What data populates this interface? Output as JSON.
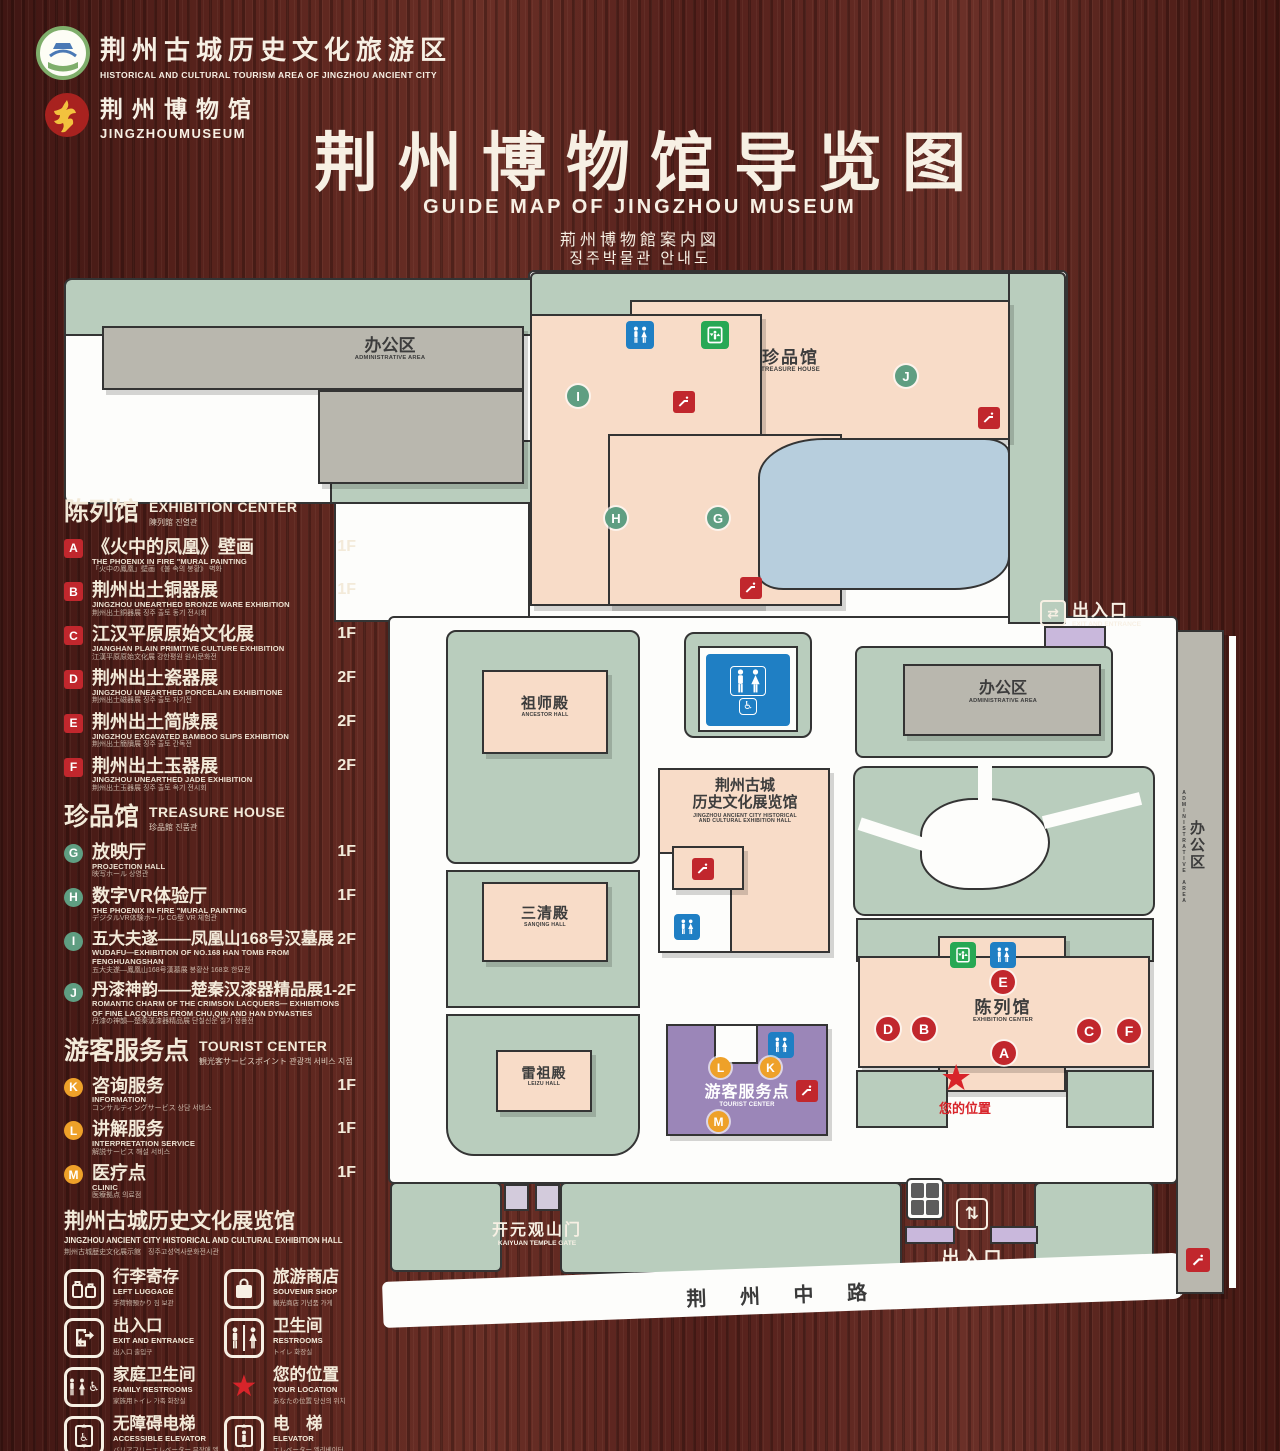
{
  "header": {
    "logo1": {
      "zh": "荆州古城历史文化旅游区",
      "en": "HISTORICAL AND CULTURAL TOURISM AREA OF JINGZHOU ANCIENT CITY"
    },
    "logo2": {
      "zh": "荆州博物馆",
      "en": "JINGZHOUMUSEUM"
    },
    "title": "荆州博物馆导览图",
    "subtitle_en": "GUIDE MAP OF JINGZHOU MUSEUM",
    "subtitle_ja": "荊州博物館案内図",
    "subtitle_ko": "징주박물관 안내도"
  },
  "panel": {
    "exhibition": {
      "zh": "陈列馆",
      "en": "EXHIBITION CENTER",
      "sub": "陳列館  진열관",
      "items": [
        {
          "k": "A",
          "zh": "《火中的凤凰》壁画",
          "en": "THE PHOENIX IN FIRE \"MURAL PAINTING",
          "sub": "「火中の鳳凰」壁画  《불 속의 봉황》 벽화",
          "floor": "1F"
        },
        {
          "k": "B",
          "zh": "荆州出土铜器展",
          "en": "JINGZHOU UNEARTHED BRONZE WARE EXHIBITION",
          "sub": "荆州出土銅器展  징주 출토 동기 전시회",
          "floor": "1F"
        },
        {
          "k": "C",
          "zh": "江汉平原原始文化展",
          "en": "JIANGHAN PLAIN PRIMITIVE CULTURE EXHIBITION",
          "sub": "江漢平原原始文化展  강한평원 원시문화전",
          "floor": "1F"
        },
        {
          "k": "D",
          "zh": "荆州出土瓷器展",
          "en": "JINGZHOU UNEARTHED PORCELAIN EXHIBITIONE",
          "sub": "荆州出土磁器展  징주 출토 자기전",
          "floor": "2F"
        },
        {
          "k": "E",
          "zh": "荆州出土简牍展",
          "en": "JINGZHOU EXCAVATED BAMBOO SLIPS EXHIBITION",
          "sub": "荆州出土簡牘展  징주 출토 간독전",
          "floor": "2F"
        },
        {
          "k": "F",
          "zh": "荆州出土玉器展",
          "en": "JINGZHOU UNEARTHED JADE EXHIBITION",
          "sub": "荆州出土玉器展  징주 출토 옥기 전시회",
          "floor": "2F"
        }
      ]
    },
    "treasure": {
      "zh": "珍品馆",
      "en": "TREASURE HOUSE",
      "sub": "珍品館  진품관",
      "items": [
        {
          "k": "G",
          "zh": "放映厅",
          "en": "PROJECTION HALL",
          "sub": "映写ホール  상영관",
          "floor": "1F"
        },
        {
          "k": "H",
          "zh": "数字VR体验厅",
          "en": "THE PHOENIX IN FIRE \"MURAL PAINTING",
          "sub": "デジタルVR体験ホール  CG型 VR 체험관",
          "floor": "1F"
        },
        {
          "k": "I",
          "zh": "五大夫遂——凤凰山168号汉墓展",
          "en": "WUDAFU—EXHIBITION OF NO.168 HAN TOMB FROM FENGHUANGSHAN",
          "sub": "五大夫遂—鳳凰山168号漢墓展  봉황산 168호 한묘전",
          "floor": "2F"
        },
        {
          "k": "J",
          "zh": "丹漆神韵——楚秦汉漆器精品展",
          "en": "ROMANTIC CHARM OF THE CRIMSON LACQUERS— EXHIBITIONS OF FINE LACQUERS FROM CHU,QIN AND HAN DYNASTIES",
          "sub": "丹漆の神韻—楚秦漢漆器精品展  단칠신운 칠기 정품전",
          "floor": "1-2F"
        }
      ]
    },
    "tourist": {
      "zh": "游客服务点",
      "en": "TOURIST CENTER",
      "sub": "観光客サービスポイント  관광객 서비스 지점",
      "items": [
        {
          "k": "K",
          "zh": "咨询服务",
          "en": "INFORMATION",
          "sub": "コンサルティングサービス  상담 서비스",
          "floor": "1F"
        },
        {
          "k": "L",
          "zh": "讲解服务",
          "en": "INTERPRETATION SERVICE",
          "sub": "解説サービス  해설 서비스",
          "floor": "1F"
        },
        {
          "k": "M",
          "zh": "医疗点",
          "en": "CLINIC",
          "sub": "医療拠点  의료점",
          "floor": "1F"
        }
      ]
    },
    "hall": {
      "zh": "荆州古城历史文化展览馆",
      "en": "JINGZHOU ANCIENT CITY HISTORICAL AND CULTURAL EXHIBITION HALL",
      "sub": "荆州古城歴史文化展示館　징주고성역사문화전시관"
    },
    "legend": {
      "items": [
        {
          "zh": "行李寄存",
          "en": "LEFT LUGGAGE",
          "sub": "手荷物預かり  짐 보관"
        },
        {
          "zh": "旅游商店",
          "en": "SOUVENIR SHOP",
          "sub": "観光商店  기념품 가게"
        },
        {
          "zh": "出入口",
          "en": "EXIT AND ENTRANCE",
          "sub": "出入口  출입구"
        },
        {
          "zh": "卫生间",
          "en": "RESTROOMS",
          "sub": "トイレ  화장실"
        },
        {
          "zh": "家庭卫生间",
          "en": "FAMILY RESTROOMS",
          "sub": "家族用トイレ  가족 화장실"
        },
        {
          "zh": "您的位置",
          "en": "YOUR LOCATION",
          "sub": "あなたの位置  당신의 위치"
        },
        {
          "zh": "无障碍电梯",
          "en": "ACCESSIBLE ELEVATOR",
          "sub": "バリアフリーエレベーター  무장애 엘리베이터"
        },
        {
          "zh": "电　梯",
          "en": "ELEVATOR",
          "sub": "エレベーター  엘리베이터"
        }
      ],
      "swatches": [
        {
          "zh": "展示区域",
          "en": "DISPLAY AREA",
          "sub": "展示エリア  전시 구역",
          "color": "#f8dcc8"
        },
        {
          "zh": "办公区域",
          "en": "OFFICE AREA",
          "sub": "オフィスエリア  사무실 구역",
          "color": "#b9b7ae"
        }
      ]
    }
  },
  "map": {
    "admin_zh": "办公区",
    "admin_en": "ADMINISTRATIVE AREA",
    "treasure_zh": "珍品馆",
    "treasure_en": "TREASURE HOUSE",
    "ancestor_zh": "祖师殿",
    "ancestor_en": "ANCESTOR HALL",
    "sanqing_zh": "三清殿",
    "sanqing_en": "SANQING HALL",
    "leizu_zh": "雷祖殿",
    "leizu_en": "LEIZU HALL",
    "history_zh1": "荆州古城",
    "history_zh2": "历史文化展览馆",
    "history_en1": "JINGZHOU ANCIENT CITY HISTORICAL",
    "history_en2": "AND CULTURAL EXHIBITION HALL",
    "tourist_zh": "游客服务点",
    "tourist_en": "TOURIST CENTER",
    "exhibition_zh": "陈列馆",
    "exhibition_en": "EXHIBITION CENTER",
    "kaiyuan_zh": "开元观山门",
    "kaiyuan_en": "KAIYUAN TEMPLE GATE",
    "exit_zh": "出入口",
    "exit_en": "EXIT AND ENTRANCE",
    "location": "您的位置",
    "road": "荆 州 中 路",
    "markers": {
      "green": [
        "I",
        "H",
        "G",
        "J"
      ],
      "red": [
        "E",
        "D",
        "B",
        "A",
        "C",
        "F"
      ],
      "orange": [
        "L",
        "K",
        "M"
      ]
    }
  }
}
